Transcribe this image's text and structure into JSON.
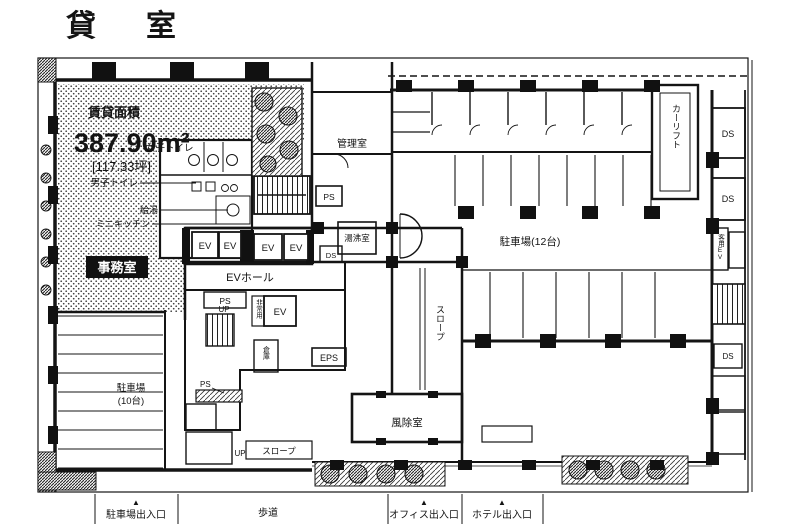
{
  "title": "貸　室",
  "rental": {
    "heading": "賃貸面積",
    "area_m2": "387.90m²",
    "area_tsubo": "[117.33坪]",
    "office": "事務室"
  },
  "labels": {
    "womens_toilet": "女子トイレ",
    "mens_toilet": "男子トイレ",
    "tea": "給湯",
    "kitchenette": "ミニキッチン",
    "mgmt_room": "管理室",
    "hot_water": "湯沸室",
    "ev": "EV",
    "ev_hall": "EVホール",
    "emergency": "非常用",
    "eps": "EPS",
    "ps": "PS",
    "ds": "DS",
    "up": "UP",
    "storage": "倉庫",
    "slope": "スロープ",
    "vestibule": "風除室",
    "car_lift": "カーリフト",
    "guest_ev": "客用EV",
    "parking_right": "駐車場(12台)",
    "parking_left_line1": "駐車場",
    "parking_left_line2": "(10台)"
  },
  "entrances": {
    "marker": "▲",
    "parking": "駐車場出入口",
    "sidewalk": "歩道",
    "office": "オフィス出入口",
    "hotel": "ホテル出入口"
  },
  "colors": {
    "ink": "#141414",
    "paper": "#ffffff"
  }
}
